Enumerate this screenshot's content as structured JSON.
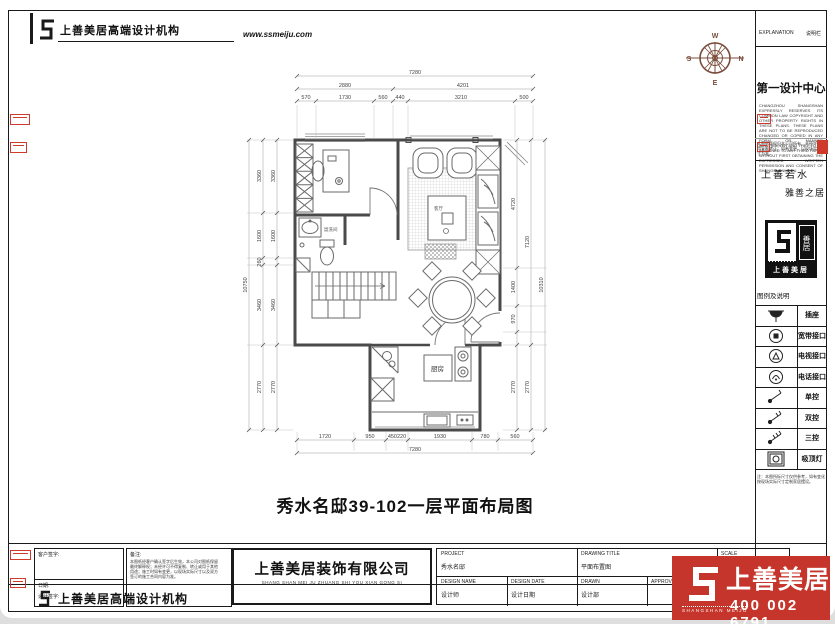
{
  "header": {
    "brand": "上善美居高端设计机构",
    "website": "www.ssmeiju.com"
  },
  "compass": {
    "n": "N",
    "s": "S",
    "e": "E",
    "w": "W"
  },
  "plan": {
    "title": "秀水名邸39-102一层平面布局图",
    "rooms": {
      "kitchen": "厨房",
      "living": "客厅",
      "bath": "盥洗间"
    },
    "dims": {
      "top_total": "7280",
      "top_row2": [
        "2880",
        "4201"
      ],
      "top_row3": [
        "570",
        "1730",
        "560",
        "440",
        "3210",
        "500"
      ],
      "bottom_row": [
        "1720",
        "950",
        "450220",
        "1930",
        "780",
        "560"
      ],
      "bottom_total": "7280",
      "left_outer": "10750",
      "left_segments": [
        "3360",
        "1600",
        "260",
        "3460",
        "2770"
      ],
      "right_inner": [
        "4720",
        "1400",
        "970",
        "2770"
      ],
      "right_mid": [
        "7120",
        "2770"
      ],
      "right_outer": "10310"
    }
  },
  "sidebar": {
    "explanation_en": "EXPLANATION",
    "explanation_cn": "说明栏",
    "design_center": "第一设计中心",
    "legal_en": "CHANGZHOU SHANGSHAN EXPRESSLY RESERVES ITS COMMON LAW COPYRIGHT AND OTHER PROPERTY RIGHTS IN THESE PLANS. THESE PLANS ARE NOT TO BE REPRODUCED CHANGED OR COPIED IN ANY FORM OR MANNER WHATSOEVER AND THEY TO BE ASSIGNED TO ANY THIRD PARTY WITHOUT FIRST OBTAINING THE EXPRESSED WRITTEN PERMISSION AND CONSENT OF SHANGSHANMEIJU.",
    "legal_cn": "本图纸版权归本公司所有，未经许可不得复制转让；如有变更，以现场实际尺寸为准。",
    "slogan_left": "上善若水",
    "slogan_right": "雅善之居",
    "stamp_name": "上善美居",
    "stamp_seal": "善居",
    "legend_title": "图例及说明",
    "legend": [
      {
        "icon": "socket-icon",
        "label": "插座"
      },
      {
        "icon": "broadband-icon",
        "label": "宽带接口"
      },
      {
        "icon": "tv-icon",
        "label": "电视接口"
      },
      {
        "icon": "phone-icon",
        "label": "电话接口"
      },
      {
        "icon": "switch-single-icon",
        "label": "单控"
      },
      {
        "icon": "switch-double-icon",
        "label": "双控"
      },
      {
        "icon": "switch-triple-icon",
        "label": "三控"
      },
      {
        "icon": "ceiling-lamp-icon",
        "label": "吸顶灯"
      }
    ],
    "legend_note": "注：本图所标尺寸仅供参考，如有变化按现场实际尺寸定制家居摆设。"
  },
  "titleblock": {
    "client_sign": "客户签字:",
    "date_label": "日期:",
    "designer_label": "设计签字:",
    "note_title": "备注:",
    "note_lines": [
      "本图纸经客户确认签字后生效，本公司对图纸保留",
      "最终解释权；未经许可不得复制、转让或用于其他",
      "用途；施工时如有变更，以现场实际尺寸以及双方",
      "签订的施工合同内容为准。"
    ],
    "company": "上善美居装饰有限公司",
    "company_pinyin": "SHANG SHAN MEI JU ZHUANG SHI YOU XIAN GONG SI",
    "project_label": "PROJECT",
    "project_value": "秀水名邸",
    "drawing_title_label": "DRAWING TITLE",
    "drawing_title_value": "平面布置图",
    "design_name_label": "DESIGN NAME",
    "design_name_value": "设计师",
    "design_date_label": "DESIGN DATE",
    "design_date_value": "设计日期",
    "drawn_label": "DRAWN",
    "drawn_value": "设计部",
    "approved_label": "APPROVED",
    "scale_label": "SCALE",
    "scale_cn": "比例",
    "footer_org": "上善美居高端设计机构"
  },
  "brand": {
    "name": "上善美居",
    "pinyin": "SHANGSHAN MEIJU",
    "phone": "400 002 6791",
    "red": "#c5352b"
  }
}
